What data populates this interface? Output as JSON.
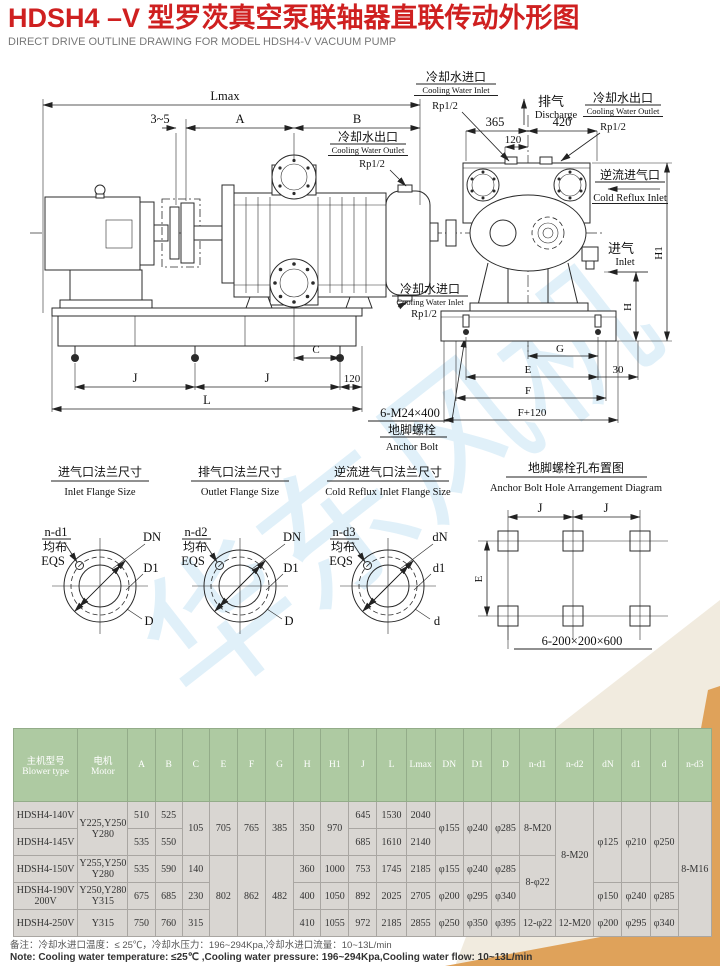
{
  "page": {
    "title": "HDSH4 –V 型罗茨真空泵联轴器直联传动外形图",
    "subtitle": "DIRECT DRIVE OUTLINE DRAWING FOR MODEL HDSH4-V VACUUM PUMP"
  },
  "colors": {
    "title_red": "#cf2020",
    "table_header_green": "#aecaa2",
    "table_cell_gray": "#d9d6d2",
    "accent_orange": "#dfa25a",
    "watermark_blue": "#d9edf8"
  },
  "drawing": {
    "watermark": "华东风机",
    "side_view": {
      "lmax": "Lmax",
      "gap": "3~5",
      "a": "A",
      "b": "B",
      "c": "C",
      "j1": "J",
      "j2": "J",
      "d120": "120",
      "l": "L",
      "outlet_cn": "冷却水出口",
      "outlet_en": "Cooling Water Outlet",
      "outlet_size": "Rp1/2",
      "inlet_cn": "冷却水进口",
      "inlet_en": "Cooling Water Inlet",
      "inlet_size": "Rp1/2",
      "anchor_spec": "6-M24×400",
      "anchor_cn": "地脚螺栓",
      "anchor_en": "Anchor Bolt"
    },
    "end_view": {
      "d365": "365",
      "d420": "420",
      "d120": "120",
      "discharge_cn": "排气",
      "discharge_en": "Discharge",
      "inlet_port_cn": "冷却水进口",
      "inlet_port_en": "Cooling Water Inlet",
      "inlet_port_size": "Rp1/2",
      "outlet_port_cn": "冷却水出口",
      "outlet_port_en": "Cooling Water Outlet",
      "outlet_port_size": "Rp1/2",
      "reflux_cn": "逆流进气口",
      "reflux_en": "Cold Reflux Inlet",
      "inlet_cn": "进气",
      "inlet_en": "Inlet",
      "h": "H",
      "h1": "H1",
      "g": "G",
      "e": "E",
      "d30": "30",
      "f": "F",
      "f120": "F+120"
    },
    "flanges": [
      {
        "title_cn": "进气口法兰尺寸",
        "title_en": "Inlet Flange Size",
        "holes": "n-d1",
        "eqs_cn": "均布",
        "eqs_en": "EQS",
        "dn": "DN",
        "d1": "D1",
        "d": "D"
      },
      {
        "title_cn": "排气口法兰尺寸",
        "title_en": "Outlet Flange Size",
        "holes": "n-d2",
        "eqs_cn": "均布",
        "eqs_en": "EQS",
        "dn": "DN",
        "d1": "D1",
        "d": "D"
      },
      {
        "title_cn": "逆流进气口法兰尺寸",
        "title_en": "Cold Reflux Inlet Flange Size",
        "holes": "n-d3",
        "eqs_cn": "均布",
        "eqs_en": "EQS",
        "dn": "dN",
        "d1": "d1",
        "d": "d"
      }
    ],
    "anchor_diagram": {
      "title_cn": "地脚螺栓孔布置图",
      "title_en": "Anchor Bolt Hole Arrangement Diagram",
      "j1": "J",
      "j2": "J",
      "e": "E",
      "spec": "6-200×200×600"
    }
  },
  "table": {
    "headers": [
      "主机型号\nBlower type",
      "电机\nMotor",
      "A",
      "B",
      "C",
      "E",
      "F",
      "G",
      "H",
      "H1",
      "J",
      "L",
      "Lmax",
      "DN",
      "D1",
      "D",
      "n-d1",
      "n-d2",
      "dN",
      "d1",
      "d",
      "n-d3"
    ],
    "rows": [
      {
        "cells": [
          "HDSH4-140V",
          "Y225,Y250\nY280",
          "510",
          "525",
          "105",
          "705",
          "765",
          "385",
          "350",
          "970",
          "645",
          "1530",
          "2040",
          "φ155",
          "φ240",
          "φ285",
          "8-M20",
          "8-M20",
          "φ125",
          "φ210",
          "φ250",
          "8-M16"
        ]
      },
      {
        "cells": [
          "HDSH4-145V",
          "535",
          "550",
          "685",
          "1610",
          "2140"
        ]
      },
      {
        "cells": [
          "HDSH4-150V",
          "Y255,Y250\nY280",
          "535",
          "590",
          "140",
          "802",
          "862",
          "482",
          "360",
          "1000",
          "753",
          "1745",
          "2185",
          "φ155",
          "φ240",
          "φ285",
          "8-φ22"
        ]
      },
      {
        "cells": [
          "HDSH4-190V\n200V",
          "Y250,Y280\nY315",
          "675",
          "685",
          "230",
          "400",
          "1050",
          "892",
          "2025",
          "2705",
          "φ200",
          "φ295",
          "φ340",
          "φ150",
          "φ240",
          "φ285"
        ]
      },
      {
        "cells": [
          "HDSH4-250V",
          "Y315",
          "750",
          "760",
          "315",
          "410",
          "1055",
          "972",
          "2185",
          "2855",
          "φ250",
          "φ350",
          "φ395",
          "12-φ22",
          "12-M20",
          "φ200",
          "φ295",
          "φ340"
        ]
      }
    ]
  },
  "notes": {
    "cn": "备注：冷却水进口温度：≤ 25℃，冷却水压力：196~294Kpa,冷却水进口流量：10~13L/min",
    "en": "Note: Cooling water temperature: ≤25℃ ,Cooling water pressure: 196~294Kpa,Cooling water flow: 10~13L/min"
  }
}
